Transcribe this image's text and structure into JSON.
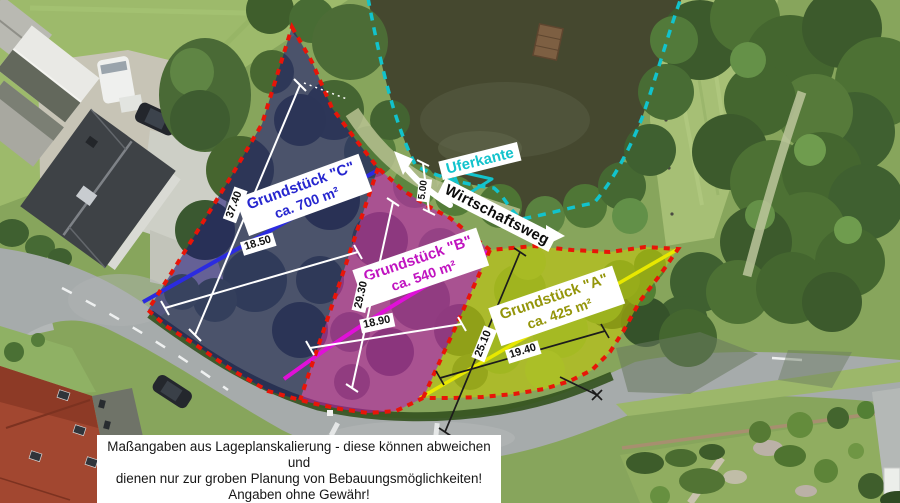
{
  "plots": [
    {
      "id": "C",
      "name": "Grundstück \"C\"",
      "area": "ca. 700 m²",
      "text_color": "#2626cf",
      "overlay_color": "#1a1078",
      "line_color": "#2b2be0"
    },
    {
      "id": "B",
      "name": "Grundstück \"B\"",
      "area": "ca. 540 m²",
      "text_color": "#c013c0",
      "overlay_color": "#c40ebe",
      "line_color": "#e010d8"
    },
    {
      "id": "A",
      "name": "Grundstück \"A\"",
      "area": "ca. 425 m²",
      "text_color": "#94950a",
      "overlay_color": "#cdcd00",
      "line_color": "#e8e800"
    }
  ],
  "measurements": [
    {
      "value": "37.40",
      "plot": "C"
    },
    {
      "value": "18.50",
      "plot": "C"
    },
    {
      "value": "29.30",
      "plot": "B"
    },
    {
      "value": "18.90",
      "plot": "B"
    },
    {
      "value": "25.10",
      "plot": "A"
    },
    {
      "value": "19.40",
      "plot": "A"
    },
    {
      "value": "5.00",
      "plot": "Wirtschaftsweg"
    }
  ],
  "annotations": {
    "shoreline_label": "Uferkante",
    "shoreline_color": "#12c3cc",
    "path_label": "Wirtschaftsweg",
    "boundary_color": "#e81508"
  },
  "disclaimer": {
    "line1": "Maßangaben aus Lageplanskalierung - diese können abweichen und",
    "line2": "dienen nur zur groben Planung von Bebauungsmöglichkeiten!",
    "line3": "Angaben ohne Gewähr!"
  }
}
